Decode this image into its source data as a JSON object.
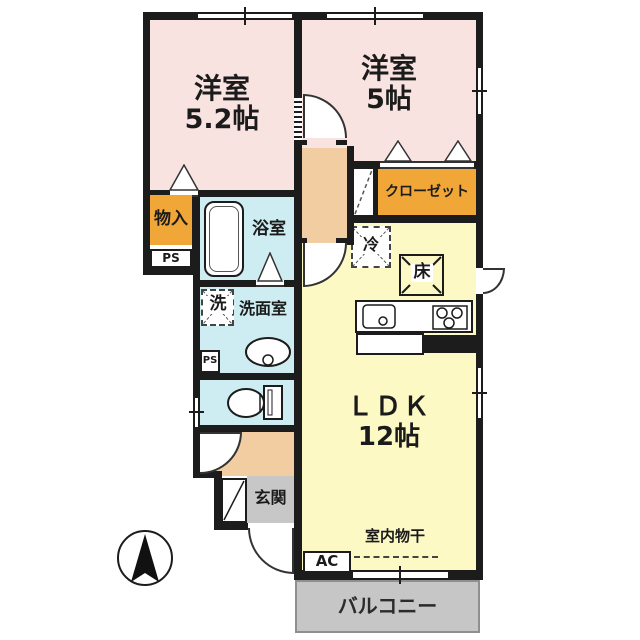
{
  "floorplan": {
    "bedroom1": {
      "name": "洋室",
      "size": "5.2帖"
    },
    "bedroom2": {
      "name": "洋室",
      "size": "5帖"
    },
    "ldk": {
      "name": "ＬＤＫ",
      "size": "12帖"
    },
    "closet": "クローゼット",
    "storage": "物入",
    "ps_upper": "PS",
    "ps_lower": "PS",
    "bath": "浴室",
    "washer": "洗",
    "washroom": "洗面室",
    "fridge": "冷",
    "floor_storage": "床",
    "entrance": "玄関",
    "indoor_drying": "室内物干",
    "ac": "AC",
    "balcony": "バルコニー"
  },
  "colors": {
    "wall": "#1c1c1c",
    "bedroom_floor": "#f8e3e1",
    "corridor_floor": "#f3cda2",
    "wet_area_floor": "#cdedf2",
    "ldk_floor": "#fcf9c4",
    "closet_fill": "#f0a737",
    "entrance_fill": "#c7c7c7",
    "balcony_fill": "#c6c6c6"
  }
}
